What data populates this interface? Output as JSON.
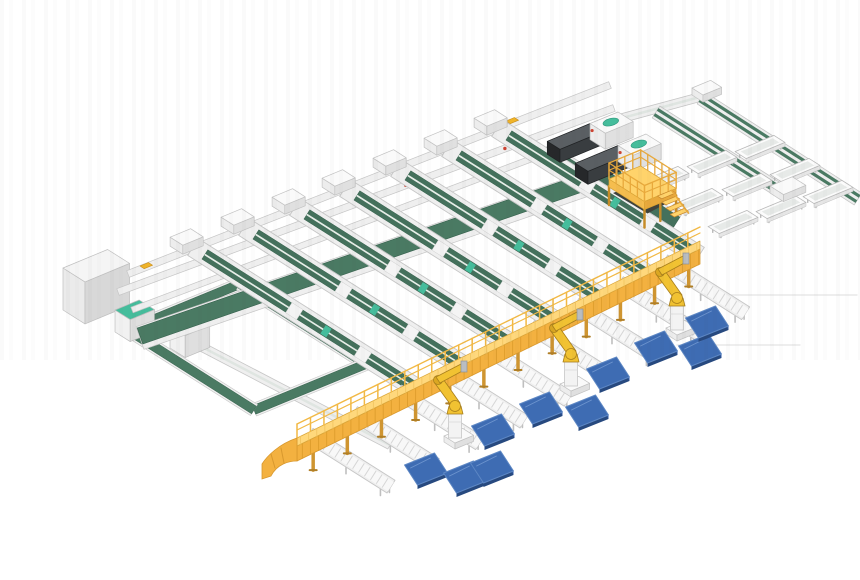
{
  "description": "Isometric 3D render of an automated conveyor sortation system with belt lanes, infeed machines, a yellow gantry discharge conveyor, palletizing robots and blue pallets",
  "canvas": {
    "width": 860,
    "height": 580,
    "background": "#ffffff"
  },
  "palette": {
    "belt_green": "#44715c",
    "belt_green_dark": "#35604c",
    "band_green": "#4a7a63",
    "teal": "#45bd9c",
    "teal_dark": "#2f9a7e",
    "frame": "#efefef",
    "frame_edge": "#c6c6c6",
    "frame_inner": "#f8f8f8",
    "rung": "#d6d6d6",
    "gantry_top": "#ffd87c",
    "gantry_face": "#f3b140",
    "gantry_rib": "#e09f2e",
    "gantry_edge": "#d8982e",
    "gantry_leg": "#cf9531",
    "rail_yellow": "#f2b945",
    "platform_top": "#ffd36b",
    "platform_left": "#f5bd4e",
    "platform_front": "#e8a93c",
    "platform_under": "#3f423c",
    "platform_leg": "#c68c28",
    "robot_yellow": "#f1c232",
    "robot_shade": "#dba722",
    "robot_outline": "#a87f1c",
    "metal_gray": "#b9bdc1",
    "pallet_top": "#3e6cb3",
    "pallet_side": "#27497f",
    "pallet_edge": "#2f57a0",
    "pallet_hi": "#5d87c4",
    "machine_top": "#5a5f63",
    "machine_side": "#26282a",
    "machine_front": "#393d40",
    "accent_yellow": "#f0b429",
    "accent_red": "#cc4433",
    "artifact": "#e9e9e9"
  },
  "axes": {
    "u": [
      0.93,
      -0.385
    ],
    "v": [
      0.845,
      0.535
    ]
  },
  "feed_lines": [
    {
      "x1": 108,
      "y1": 298,
      "x2": 390,
      "y2": 445,
      "w": 6
    },
    {
      "x1": 615,
      "y1": 120,
      "x2": 700,
      "y2": 97,
      "w": 6
    }
  ],
  "cross_bands": [
    {
      "x1": 128,
      "y1": 274,
      "x2": 610,
      "y2": 85,
      "w": 7,
      "kind": "frame"
    },
    {
      "x1": 118,
      "y1": 292,
      "x2": 614,
      "y2": 108,
      "w": 7,
      "kind": "frame"
    },
    {
      "x1": 132,
      "y1": 310,
      "x2": 618,
      "y2": 126,
      "w": 6,
      "kind": "frame"
    },
    {
      "x1": 140,
      "y1": 338,
      "x2": 622,
      "y2": 172,
      "w": 24,
      "kind": "frame"
    },
    {
      "x1": 140,
      "y1": 336,
      "x2": 620,
      "y2": 170,
      "w": 17,
      "kind": "green"
    }
  ],
  "accents": {
    "yellow": [
      [
        140,
        266
      ],
      [
        506,
        121
      ]
    ],
    "red_band_index": 1,
    "red_fractions": [
      0.18,
      0.38,
      0.58,
      0.78
    ]
  },
  "loop": {
    "corners": [
      [
        128,
        330
      ],
      [
        240,
        284
      ],
      [
        366,
        364
      ],
      [
        254,
        410
      ]
    ],
    "w": 9
  },
  "lanes": [
    {
      "x": 193,
      "y": 247,
      "len": 270
    },
    {
      "x": 244,
      "y": 227,
      "len": 265
    },
    {
      "x": 295,
      "y": 207,
      "len": 260
    },
    {
      "x": 345,
      "y": 188,
      "len": 254
    },
    {
      "x": 396,
      "y": 168,
      "len": 249
    },
    {
      "x": 447,
      "y": 148,
      "len": 243
    },
    {
      "x": 497,
      "y": 128,
      "len": 239
    }
  ],
  "machine_lanes": [
    {
      "x": 545,
      "y": 150,
      "len": 122
    },
    {
      "x": 588,
      "y": 166,
      "len": 105
    }
  ],
  "machines": [
    {
      "hx": 618,
      "hy": 112
    },
    {
      "hx": 646,
      "hy": 134
    }
  ],
  "right_branch": {
    "lines": [
      {
        "x1": 656,
        "y1": 112,
        "x2": 793,
        "y2": 199
      },
      {
        "x1": 701,
        "y1": 98,
        "x2": 858,
        "y2": 199
      }
    ],
    "corner_box": {
      "x": 692,
      "y": 88,
      "wu": 20,
      "dv": 13,
      "h": 7
    },
    "end_tray": {
      "x": 770,
      "y": 186,
      "wu": 24,
      "dv": 16,
      "h": 7
    },
    "troughs": [
      [
        760,
        147
      ],
      [
        795,
        170
      ],
      [
        828,
        192
      ],
      [
        712,
        162
      ],
      [
        747,
        185
      ],
      [
        781,
        207
      ],
      [
        664,
        178
      ],
      [
        698,
        200
      ],
      [
        733,
        222
      ]
    ]
  },
  "boxes": [
    {
      "x": 63,
      "y": 268,
      "wu": 48,
      "dv": 26,
      "h": 42,
      "kind": "cabinet",
      "name": "electrical-cabinet"
    },
    {
      "x": 115,
      "y": 310,
      "wu": 26,
      "dv": 18,
      "h": 22,
      "kind": "teal",
      "name": "tote-machine-1"
    },
    {
      "x": 170,
      "y": 326,
      "wu": 26,
      "dv": 18,
      "h": 22,
      "kind": "teal",
      "name": "tote-machine-2"
    }
  ],
  "platform": {
    "x": 609,
    "y": 179,
    "wu": 34,
    "dv": 42,
    "h": 8,
    "leg": 18,
    "rail": 16,
    "stair_steps": 4
  },
  "gantry": {
    "x1": 297,
    "y1": 452,
    "x2": 700,
    "y2": 255
  },
  "discharges": {
    "fractions": [
      0.055,
      0.165,
      0.275,
      0.385,
      0.495,
      0.605,
      0.715,
      0.825,
      0.935
    ],
    "len": 85,
    "w": 15
  },
  "robots": [
    [
      455,
      440
    ],
    [
      571,
      388
    ],
    [
      677,
      332
    ]
  ],
  "pallets": [
    [
      426,
      469
    ],
    [
      465,
      477
    ],
    [
      492,
      467
    ],
    [
      493,
      430
    ],
    [
      541,
      408
    ],
    [
      587,
      411
    ],
    [
      608,
      373
    ],
    [
      656,
      347
    ],
    [
      700,
      350
    ],
    [
      707,
      322
    ]
  ],
  "artifact_lines": [
    {
      "x1": 700,
      "y1": 295,
      "x2": 857,
      "y2": 295
    },
    {
      "x1": 677,
      "y1": 345,
      "x2": 800,
      "y2": 345
    }
  ]
}
